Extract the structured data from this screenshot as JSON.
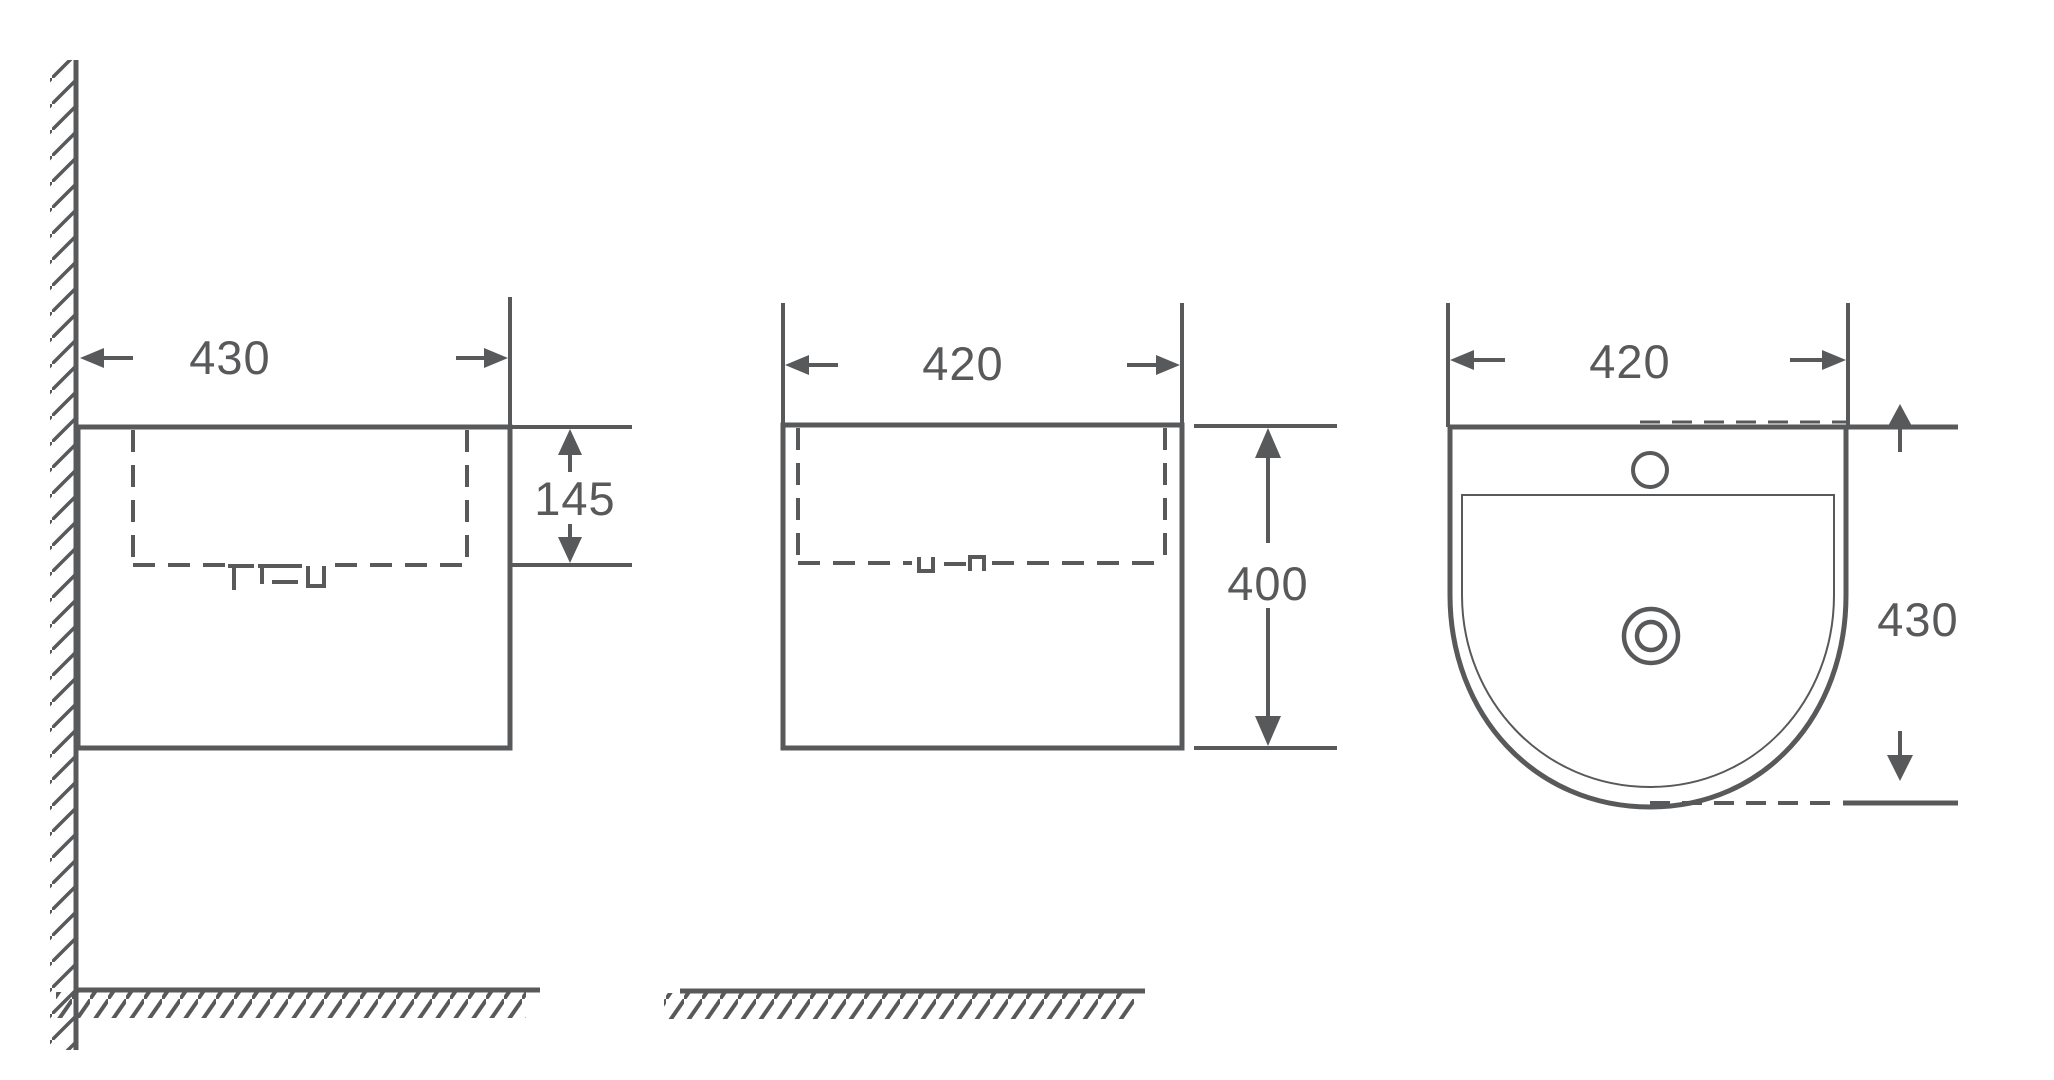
{
  "drawing": {
    "line_color": "#58595b",
    "background_color": "#ffffff",
    "dimension_labels": {
      "side_width": "430",
      "side_basin_depth": "145",
      "front_width": "420",
      "front_height": "400",
      "top_width": "420",
      "top_depth": "430"
    }
  }
}
